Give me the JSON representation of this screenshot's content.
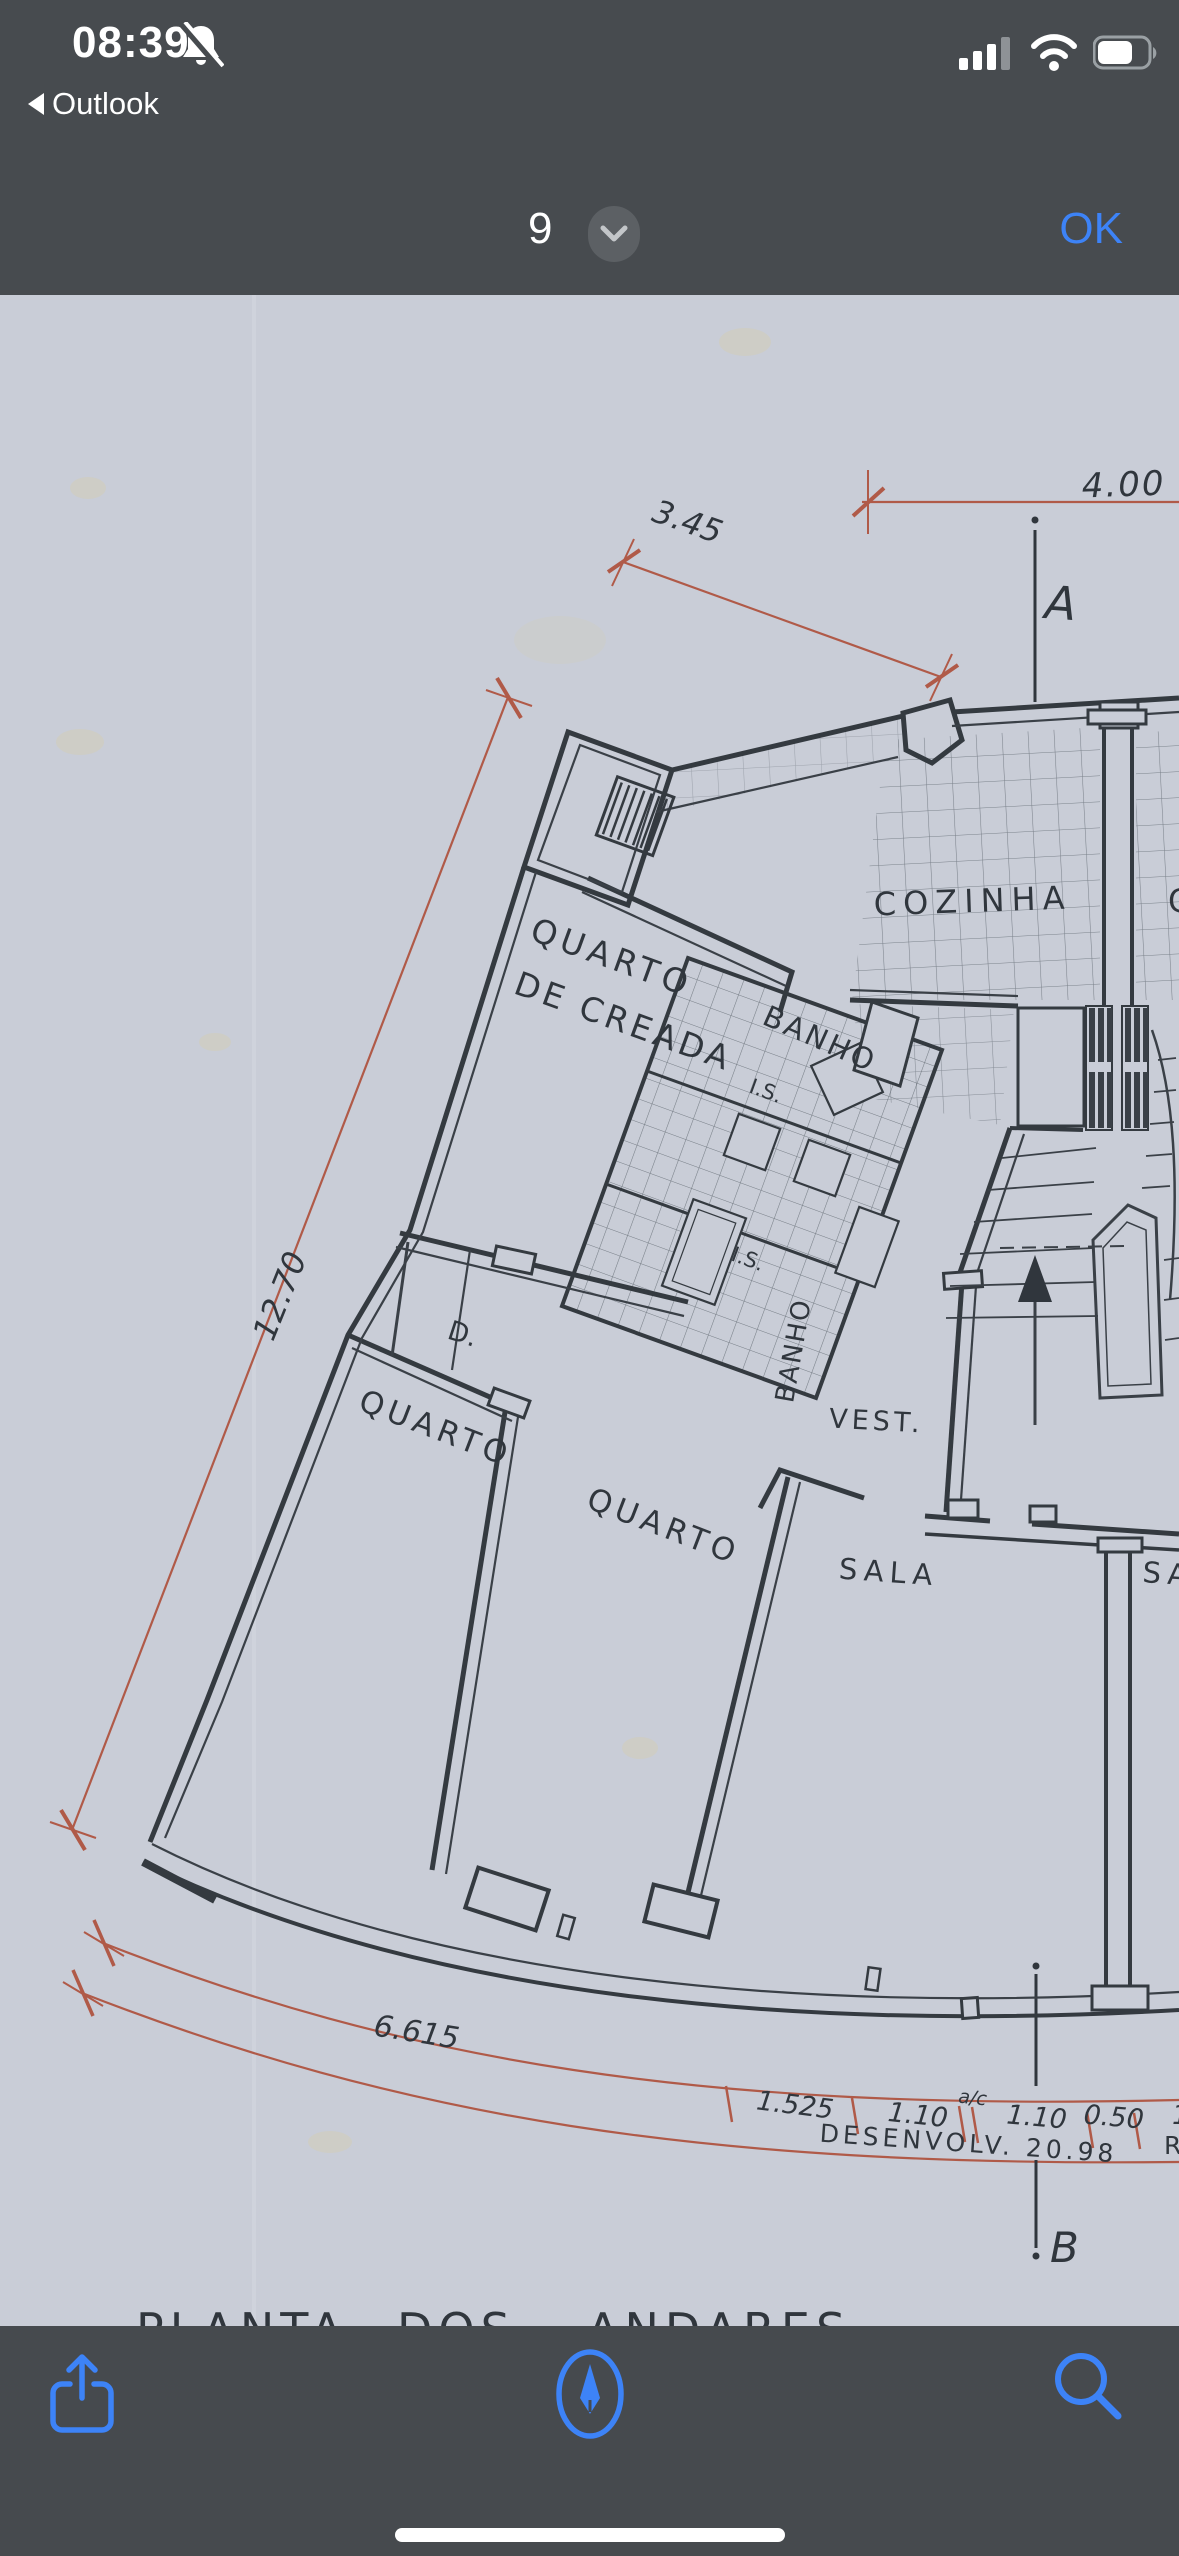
{
  "status_bar": {
    "time": "08:39",
    "back_label": "Outlook",
    "icons": [
      "bell-slash-icon",
      "cellular-signal-icon",
      "wifi-icon",
      "battery-icon"
    ],
    "colors": {
      "bar_bg": "#474b4f",
      "text": "#ffffff"
    }
  },
  "nav_bar": {
    "page_indicator": "9",
    "confirm_label": "OK",
    "accent": "#3d83f7"
  },
  "plan": {
    "title": "PLANTA DOS ANDARES",
    "title_words": [
      "PLANTA",
      "DOS",
      "ANDARES"
    ],
    "labels": {
      "room_quarto_creada_line1": "QUARTO",
      "room_quarto_creada_line2": "DE CREADA",
      "room_banho_upper": "BANHO",
      "room_cozinha": "COZINHA",
      "room_cozinha_partial": "C",
      "room_is_1": "I.S.",
      "room_is_2": "I.S.",
      "room_banho_lower": "BANHO",
      "room_closet": "D.",
      "room_quarto_left": "QUARTO",
      "room_quarto_right": "QUARTO",
      "room_vest": "VEST.",
      "room_sala": "SALA",
      "room_sala_partial": "SA",
      "section_marker_a": "A",
      "section_marker_b": "B"
    },
    "dimensions": {
      "top": "4.00",
      "diagonal": "3.45",
      "left": "12.70",
      "bottom_left": "6.615",
      "chain": [
        "1.525",
        "1.10",
        "1.10",
        "0.50"
      ],
      "chain_suffix": "a/c",
      "chain_partial": "1",
      "development": "DESENVOLV. 20.98",
      "development_partial": "R"
    },
    "colors": {
      "paper": "#c9cdd7",
      "ink": "#30363d",
      "dimension_red": "#b05a48"
    }
  },
  "toolbar": {
    "icons": [
      "share-icon",
      "markup-icon",
      "search-icon"
    ]
  }
}
